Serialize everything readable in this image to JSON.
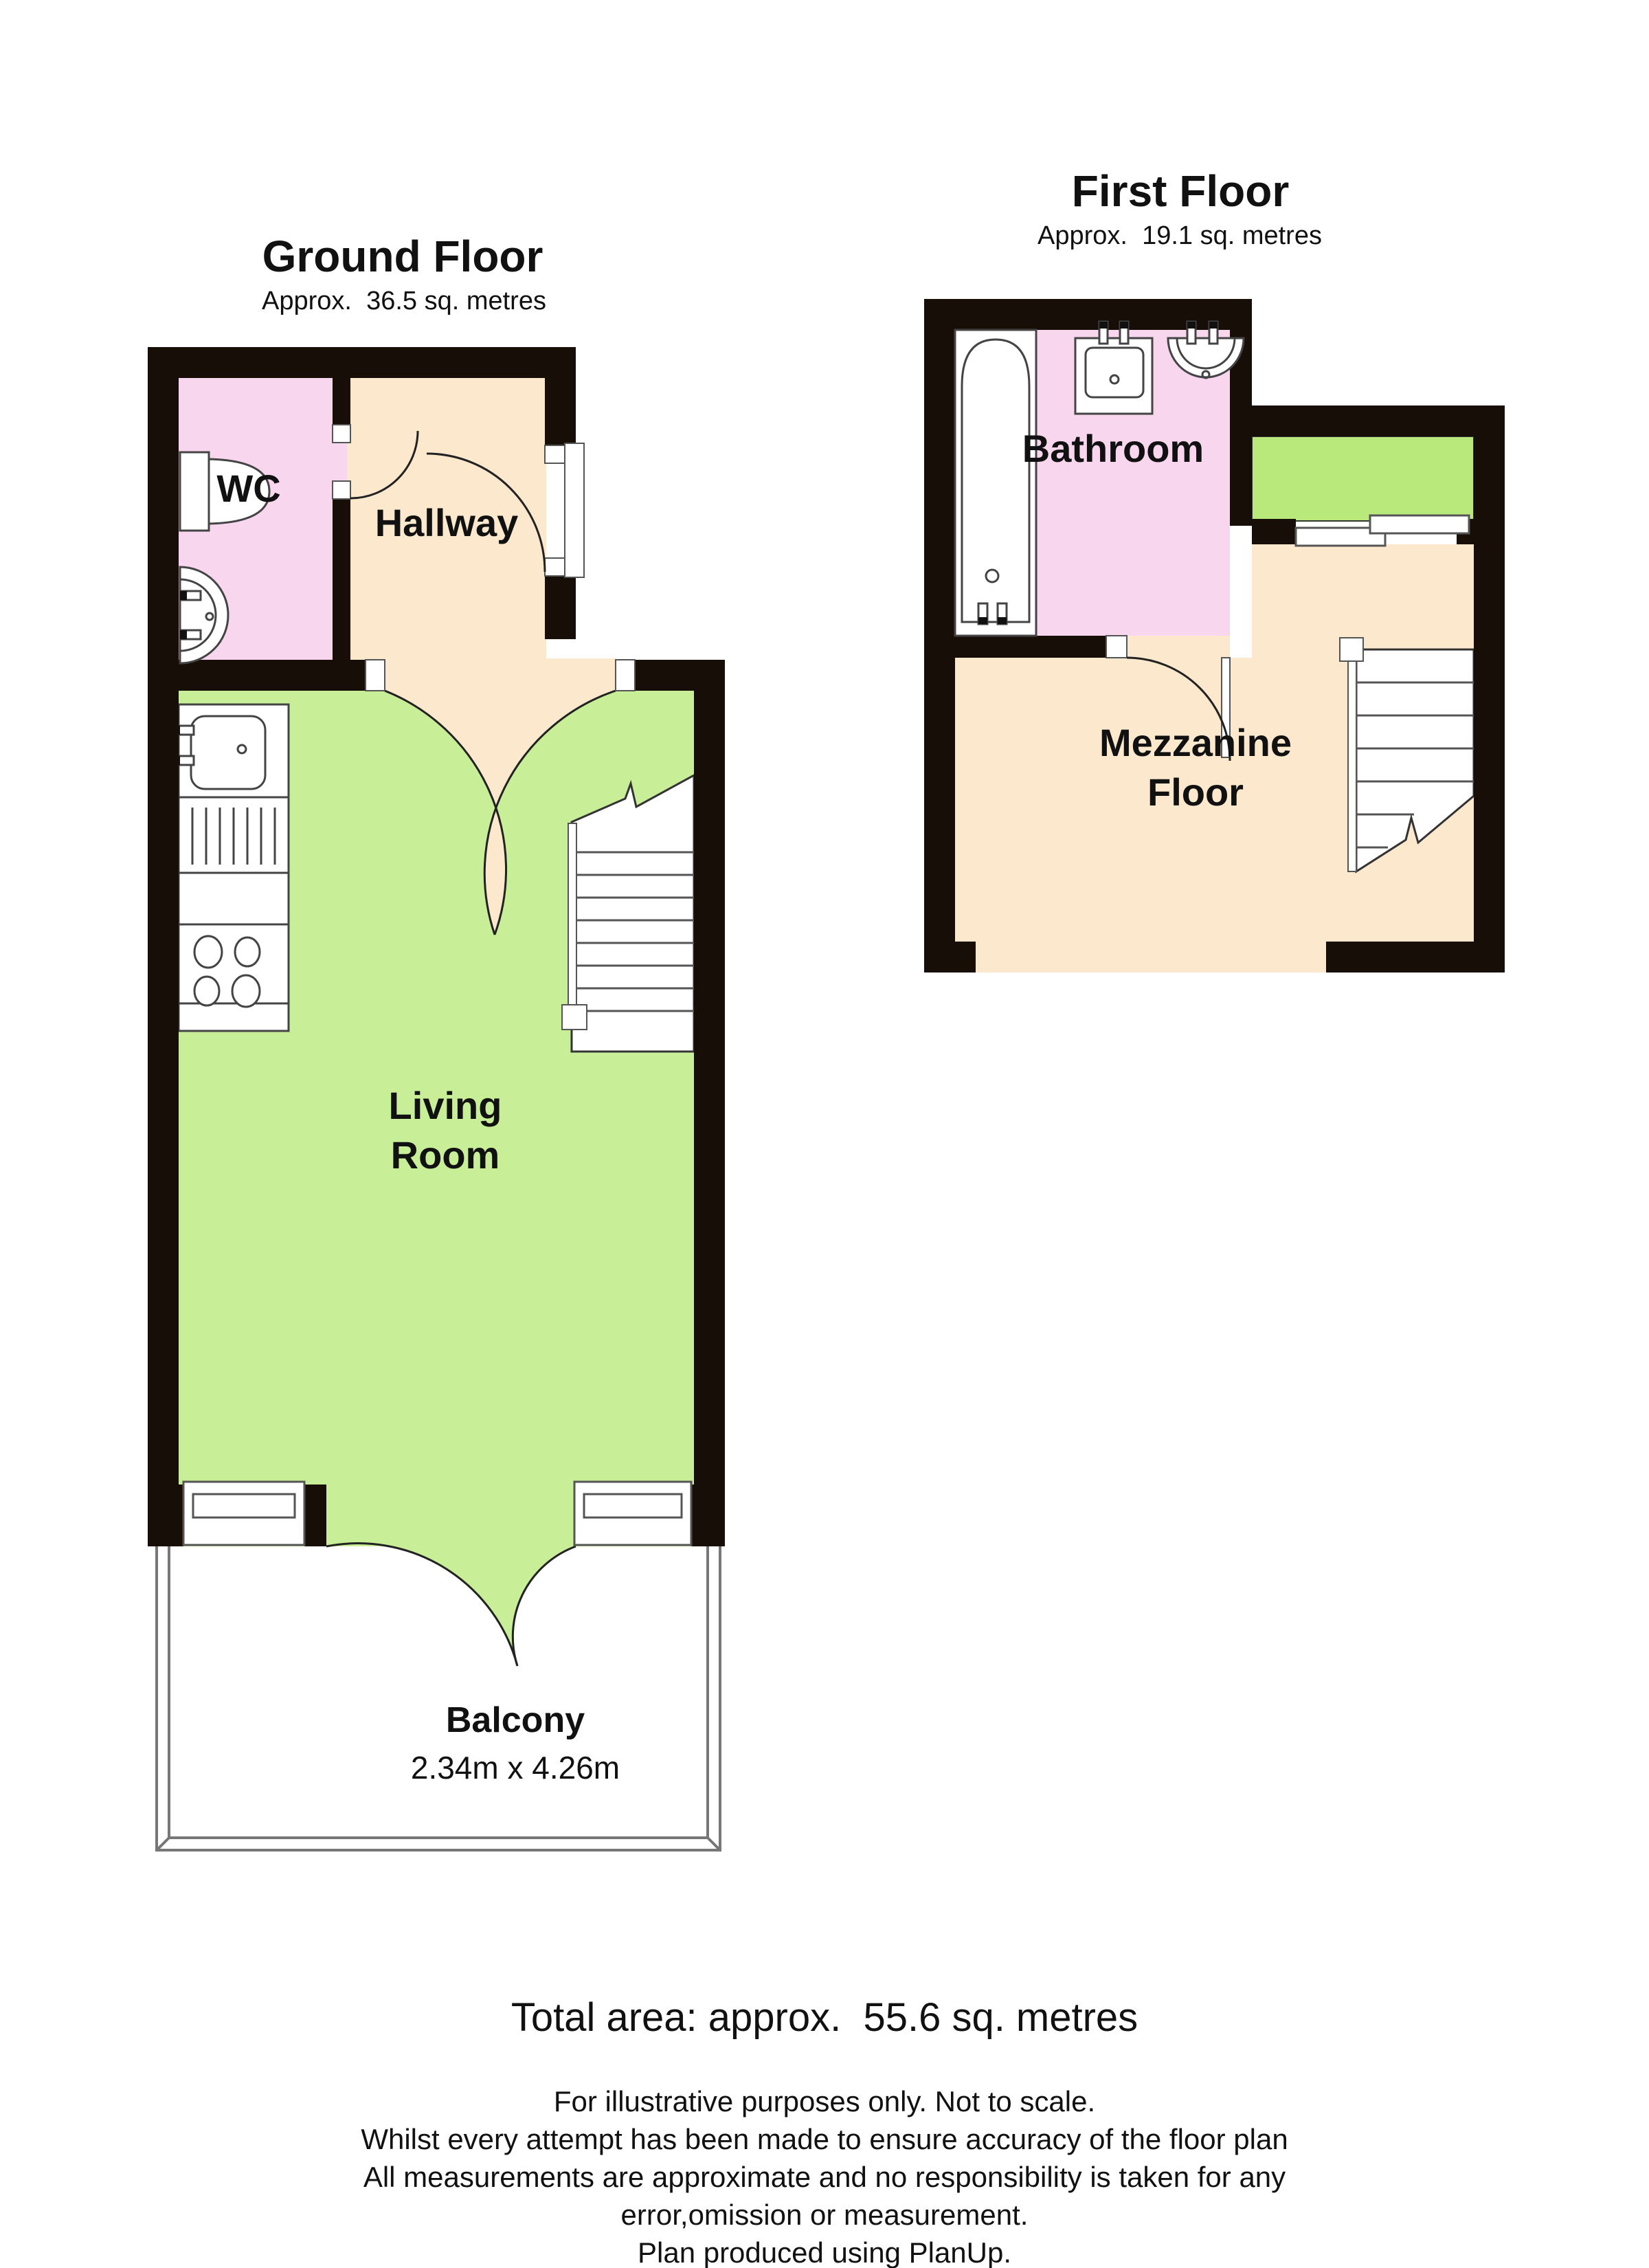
{
  "ground_floor": {
    "title": "Ground Floor",
    "area": "Approx.  36.5 sq. metres",
    "rooms": {
      "wc": "WC",
      "hallway": "Hallway",
      "living_line1": "Living",
      "living_line2": "Room",
      "balcony": "Balcony",
      "balcony_dims": "2.34m x 4.26m"
    }
  },
  "first_floor": {
    "title": "First Floor",
    "area": "Approx.  19.1 sq. metres",
    "rooms": {
      "bathroom": "Bathroom",
      "mezzanine_line1": "Mezzanine",
      "mezzanine_line2": "Floor"
    }
  },
  "footer": {
    "total_area": "Total area: approx.  55.6 sq. metres",
    "disclaimer_lines": [
      "For illustrative purposes only. Not to scale.",
      "Whilst every attempt has been made to ensure accuracy of the floor plan",
      "All measurements are approximate and no responsibility is taken for any",
      "error,omission or measurement."
    ],
    "produced_by": "Plan produced using PlanUp."
  },
  "colors": {
    "wall": "#170e07",
    "cream": "#fbe8cd",
    "pink": "#f8d6ed",
    "living_green": "#c8ee97",
    "terrace_green": "#b9e87b"
  }
}
